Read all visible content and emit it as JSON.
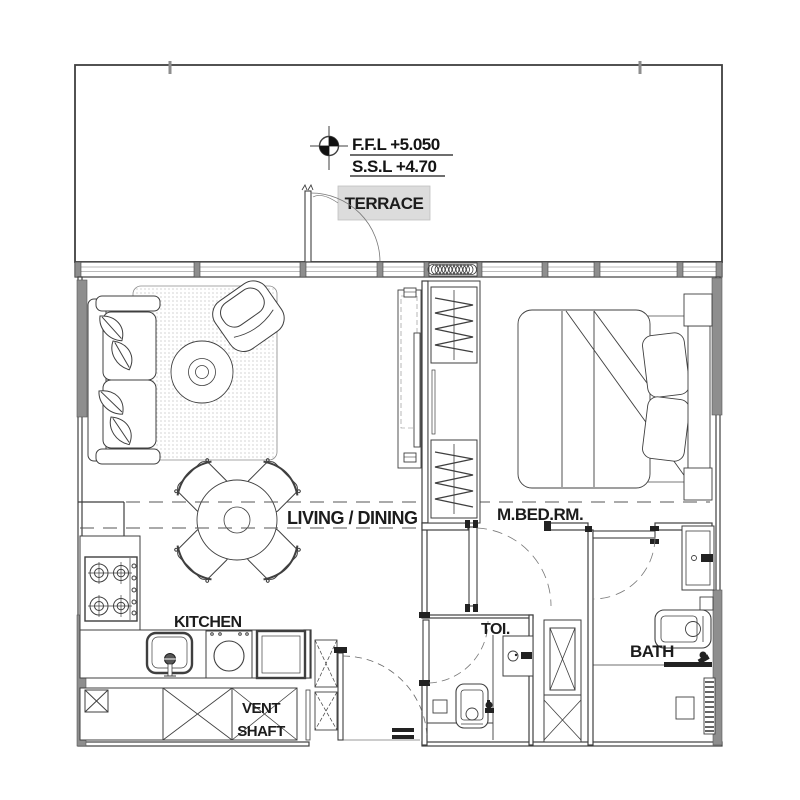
{
  "annotations": {
    "level_marker": {
      "ffl": "F.F.L +5.050",
      "ssl": "S.S.L +4.70"
    }
  },
  "rooms": {
    "terrace": {
      "label": "TERRACE"
    },
    "living_dining": {
      "label": "LIVING / DINING"
    },
    "master_bedroom": {
      "label": "M.BED.RM."
    },
    "kitchen": {
      "label": "KITCHEN"
    },
    "toilet": {
      "label": "TOI."
    },
    "bath": {
      "label": "BATH"
    },
    "vent_shaft": {
      "label_line1": "VENT",
      "label_line2": "SHAFT"
    }
  },
  "colors": {
    "ink": "#3f3f3f",
    "wall_fill": "#8e8e8e",
    "label_bg": "#dcdcdc",
    "paper": "#ffffff"
  }
}
